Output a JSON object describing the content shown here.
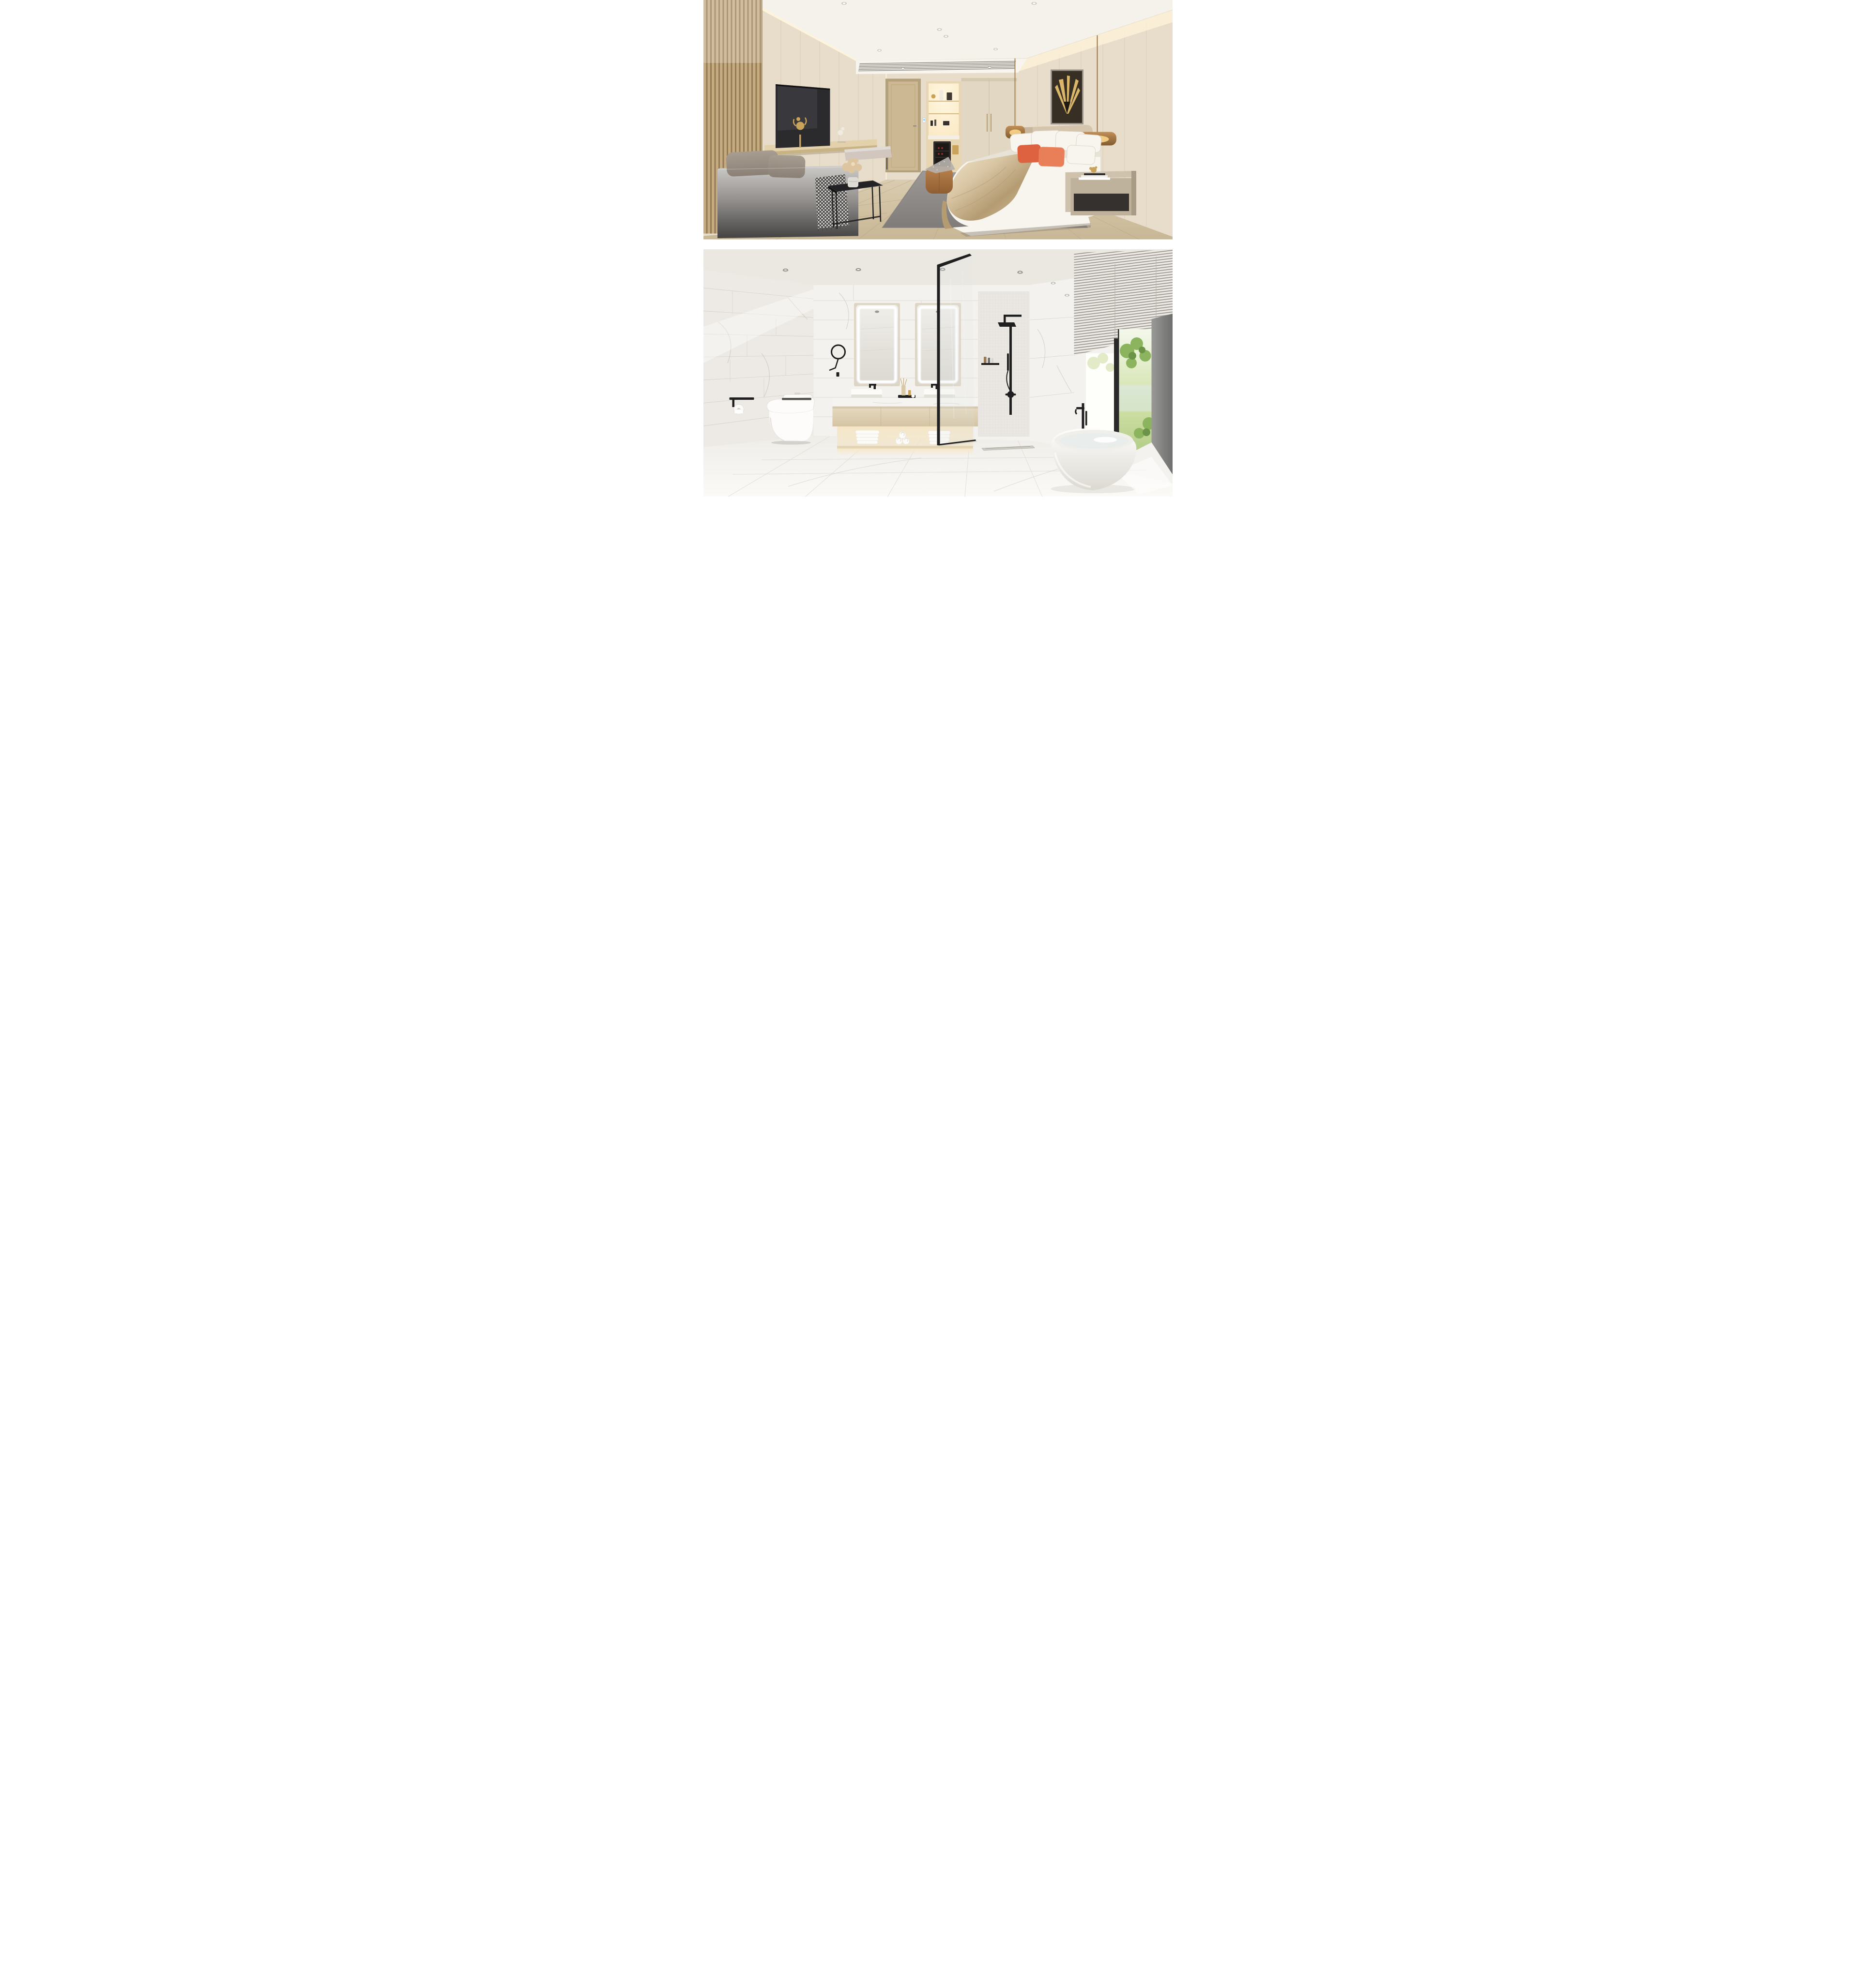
{
  "page": {
    "label": "Interior design render sheet: hotel guest room and bathroom",
    "background": "#ffffff"
  },
  "scenes": {
    "bedroom": {
      "label": "Render 1: beige modern hotel bedroom with slatted wood wall, TV lounge sofa, double bed with orange pillows"
    },
    "bathroom": {
      "label": "Render 2: white marble bathroom with lit double vanity, black shower fittings, blinds window and freestanding oval tub"
    }
  },
  "palette": {
    "page_bg": "#ffffff",
    "bd_ceiling": "#f5f2ec",
    "bd_wall": "#e7ddca",
    "bd_wall_dark": "#cfc0a6",
    "bd_soffit": "#f8f5ef",
    "bd_vent": "#6b675f",
    "bd_cove": "#fff3d8",
    "bd_slat_light": "#c6ab80",
    "bd_slat_dark": "#927a54",
    "bd_tv": "#2b2b2e",
    "bd_tv_hi": "#45454b",
    "bd_shelf": "#e2d1ab",
    "bd_shelf_side": "#c8b384",
    "bd_door": "#ccb892",
    "bd_door_frame": "#b3a17b",
    "bd_switch": "#8fd0ee",
    "bd_niche_wood": "#e7d6b1",
    "bd_niche_glow": "#fbe9c4",
    "bd_fridge": "#2e2a28",
    "bd_wine": "#8a3030",
    "bd_gold": "#c9a35a",
    "bd_art_bg": "#372f24",
    "bd_art_gold": "#d9b66a",
    "bd_art_frame": "#9a948a",
    "bd_headboard": "#d4c5ac",
    "bd_bed_white": "#f8f5ee",
    "bd_bed_shade": "#e0dbcd",
    "bd_satin": "#d9c6a4",
    "bd_satin_hi": "#f0e5cb",
    "bd_satin_dark": "#b49b72",
    "bd_orange": "#df6240",
    "bd_orange2": "#e87f58",
    "bd_lamp_amber": "#c08b52",
    "bd_lamp_amber_dark": "#7c5426",
    "bd_lamp_glow": "#ffd98f",
    "bd_lamp_stem": "#8a6a3a",
    "bd_nightstand": "#cfc2ad",
    "bd_nightstand_dark": "#a99c87",
    "bd_nightstand_shelf": "#34312e",
    "bd_rug": "#9d9997",
    "bd_rug_dark": "#807c7a",
    "bd_floor": "#daccb0",
    "bd_floor_dark": "#c8b795",
    "bd_plank": "#b2a07a",
    "bd_sofa_top": "#cdcbc7",
    "bd_sofa_bottom": "#454443",
    "bd_cushion": "#a89d91",
    "bd_cushion_dark": "#8a8075",
    "bd_throw_light": "#e9e7e3",
    "bd_throw_dark": "#3a3836",
    "bd_table": "#232325",
    "bd_table_hi": "#4a4a50",
    "bd_ottoman": "#bb8350",
    "bd_ottoman_dark": "#8f5e31",
    "bd_flower": "#ddc5a0",
    "bd_vase": "#dedbd5",
    "bd_bench": "#d2c7bf",
    "bd_bench_leg": "#4c4a48",
    "bd_sculpt": "#f0eae0",
    "bd_shadow": "#8a8070",
    "ba_ceiling": "#ebe8e2",
    "ba_wall": "#f4f2ee",
    "ba_grout": "#d8d4cc",
    "ba_vein": "#c8c3ba",
    "ba_mosaic": "#eae7e2",
    "ba_mirror_frame": "#ded5c5",
    "ba_mirror_glass": "#f0eee9",
    "ba_mirror_glass_dark": "#dbd8d1",
    "ba_black": "#1f1f1f",
    "ba_counter": "#f6f4f0",
    "ba_vanity": "#e6dac0",
    "ba_vanity_dark": "#d4c4a3",
    "ba_glow": "#f8e8ca",
    "ba_shelf_wood": "#e4d5b2",
    "ba_towel": "#fcfbf7",
    "ba_towel_shade": "#e3e0d9",
    "ba_toilet": "#fdfcfa",
    "ba_toilet_shade": "#e5e2db",
    "ba_seat_dark": "#55524e",
    "ba_blind": "#edeae5",
    "ba_blind_gap": "#97938c",
    "ba_cove": "#ffe9c0",
    "ba_win_bright": "#fefefb",
    "ba_tree": "#8cb45e",
    "ba_tree_dark": "#6c9448",
    "ba_tree_light": "#d9e4b8",
    "ba_haze": "#dce8ea",
    "ba_gray_wall": "#999997",
    "ba_gray_wall_dark": "#6e6e6c",
    "ba_tub": "#fdfdfb",
    "ba_tub_shade": "#dcd9d2",
    "ba_water": "#e9edec",
    "ba_floor": "#f6f4f0",
    "ba_floor_line": "#ddd9d2",
    "ba_sill": "#f4f2ee"
  }
}
